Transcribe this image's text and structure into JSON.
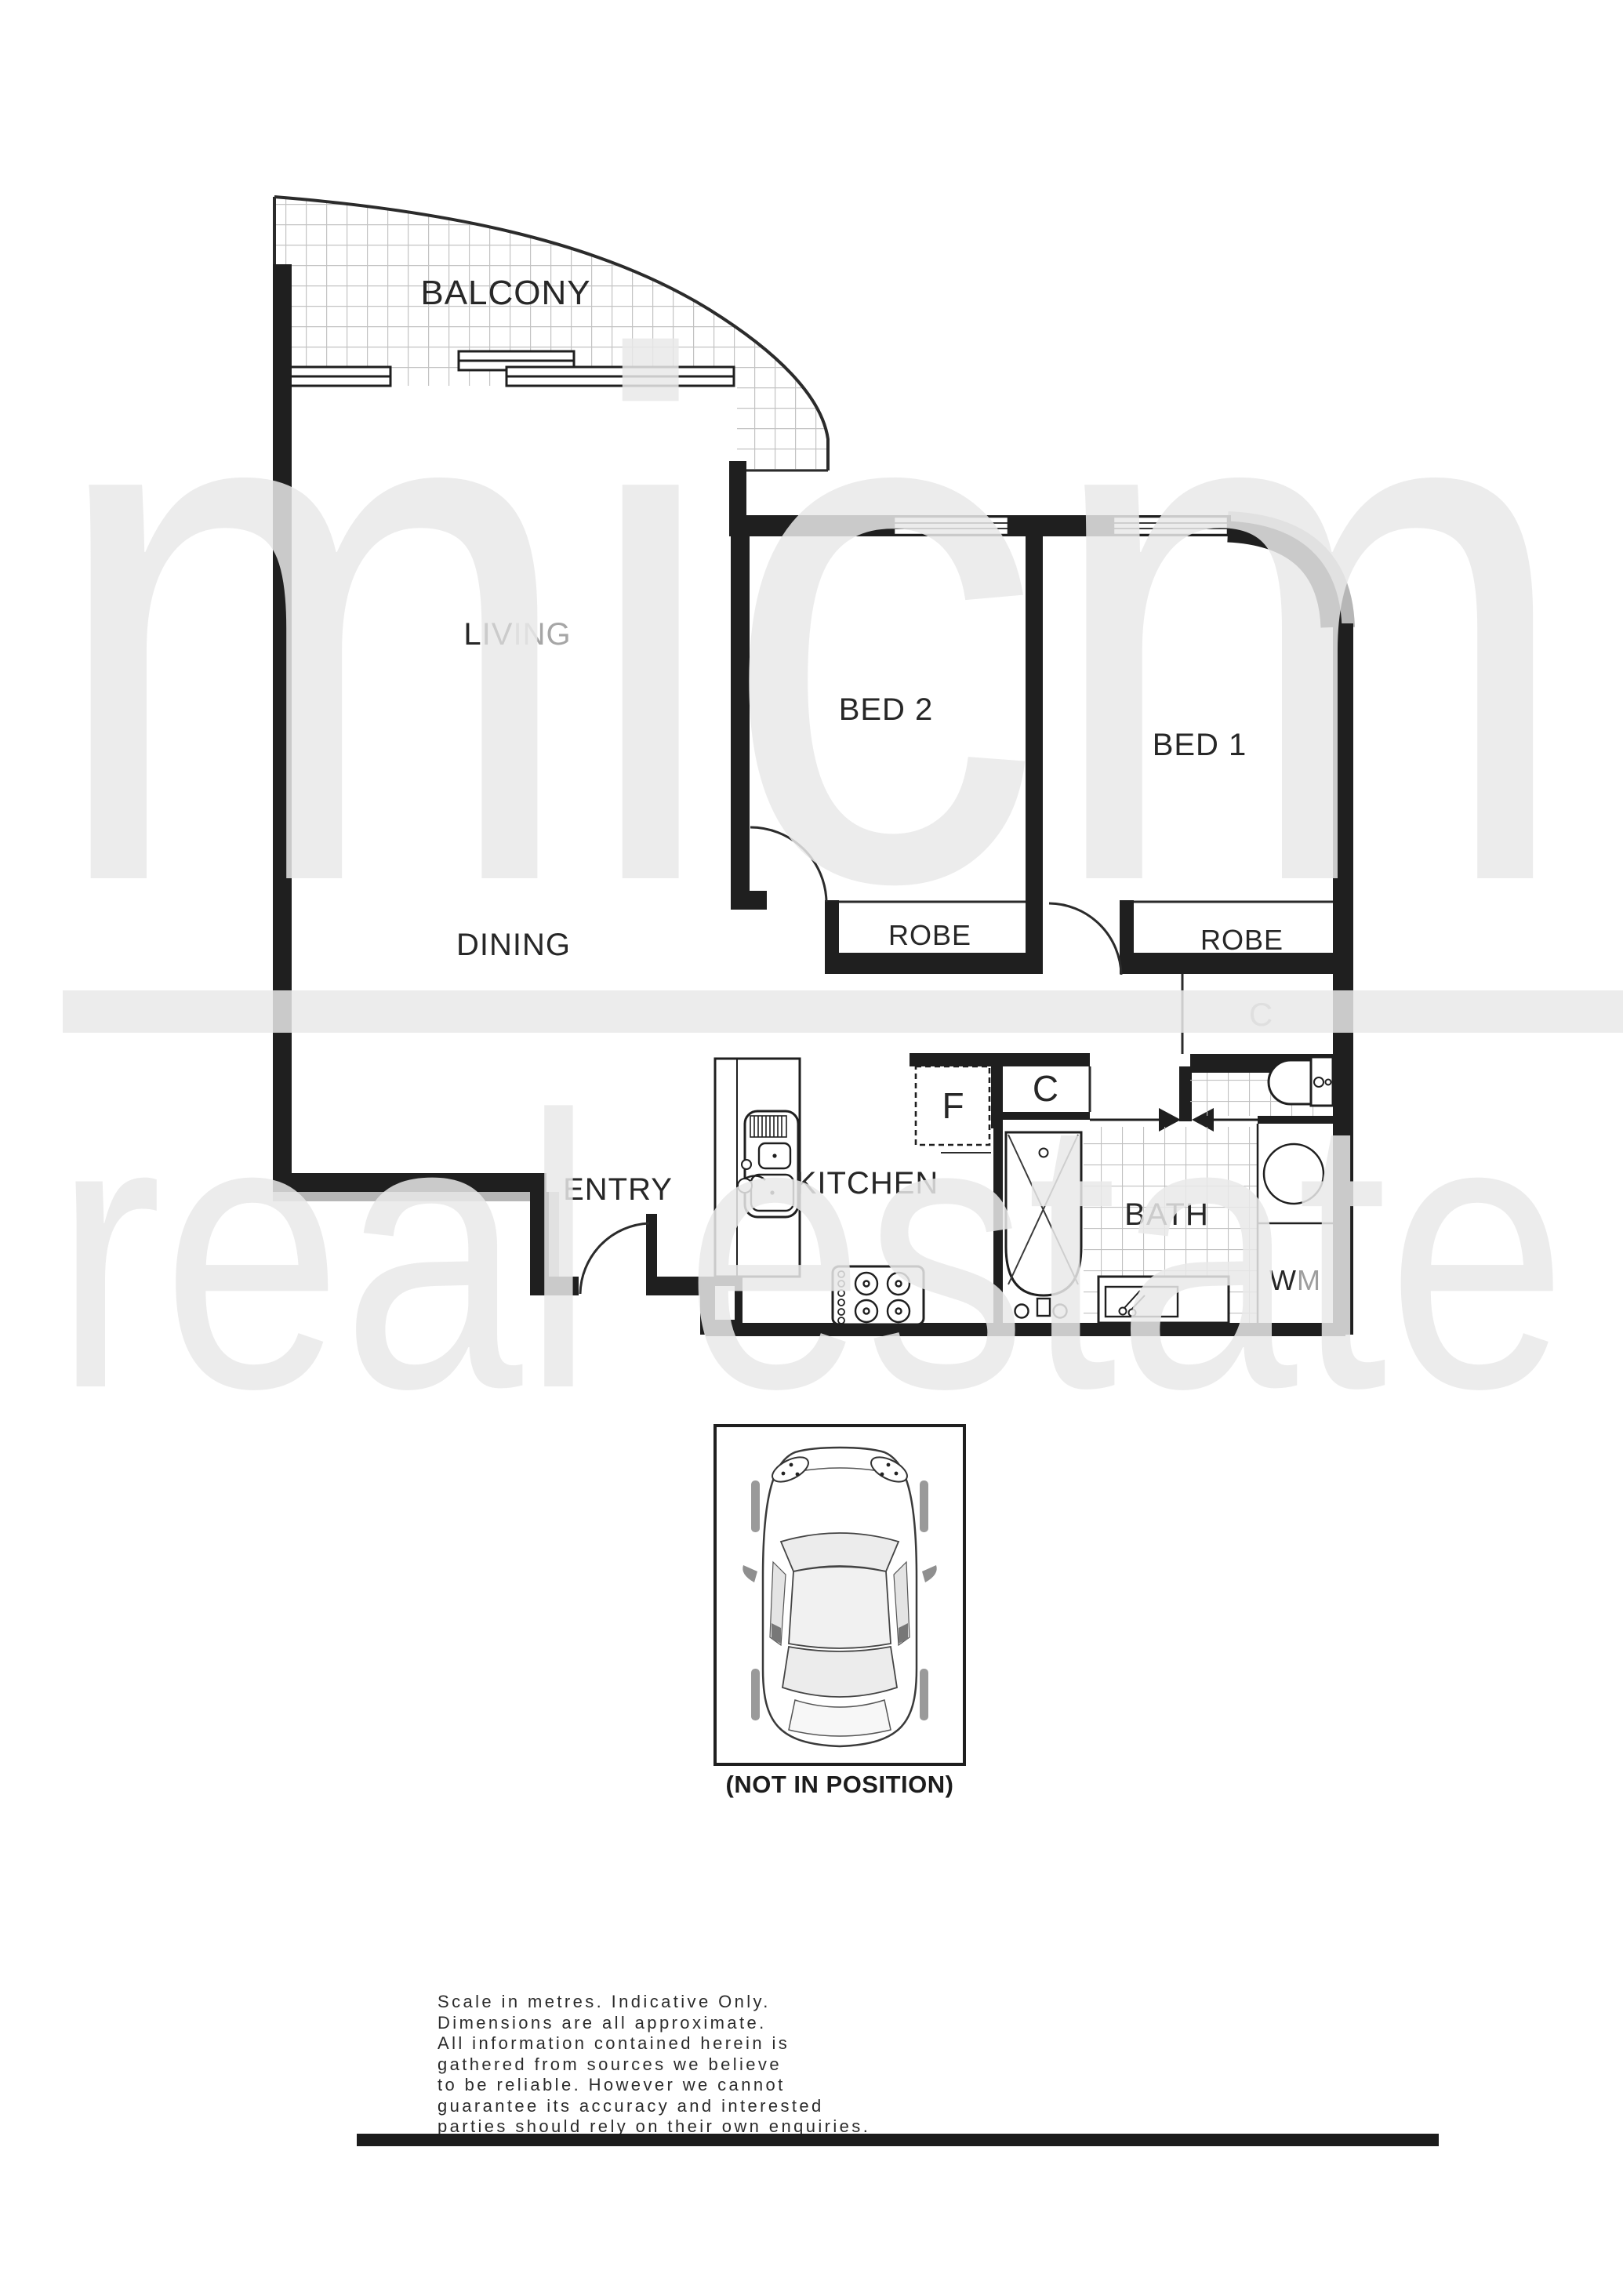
{
  "watermark": {
    "brand": "micm",
    "tagline": "real estate",
    "color": "#e9e9e9"
  },
  "floorplan": {
    "balcony": "BALCONY",
    "living_prefix": "LIV",
    "living_suffix": "ING",
    "dining": "DINING",
    "bed2": "BED 2",
    "bed1": "BED 1",
    "robe_bed2": "ROBE",
    "robe_bed1": "ROBE",
    "linen_cupboard": "C",
    "fridge": "F",
    "cupboard": "C",
    "kitchen": "KITCHEN",
    "entry": "ENTRY",
    "bath": "BATH",
    "wm_prefix": "W",
    "wm_suffix": "M"
  },
  "carpark": {
    "caption": "(NOT IN POSITION)"
  },
  "disclaimer": {
    "lines": [
      "Scale in metres. Indicative Only.",
      "Dimensions are all approximate.",
      "All information contained herein is",
      "gathered from sources we believe",
      "to be reliable. However we cannot",
      "guarantee its accuracy and interested",
      "parties should rely on their own enquiries."
    ]
  },
  "colors": {
    "wall": "#1f1f1f",
    "thin_line": "#2b2b2b",
    "tile_line": "#c3c3c3",
    "shadow": "#b6b6b6",
    "footer_bar": "#1c1c1c"
  }
}
